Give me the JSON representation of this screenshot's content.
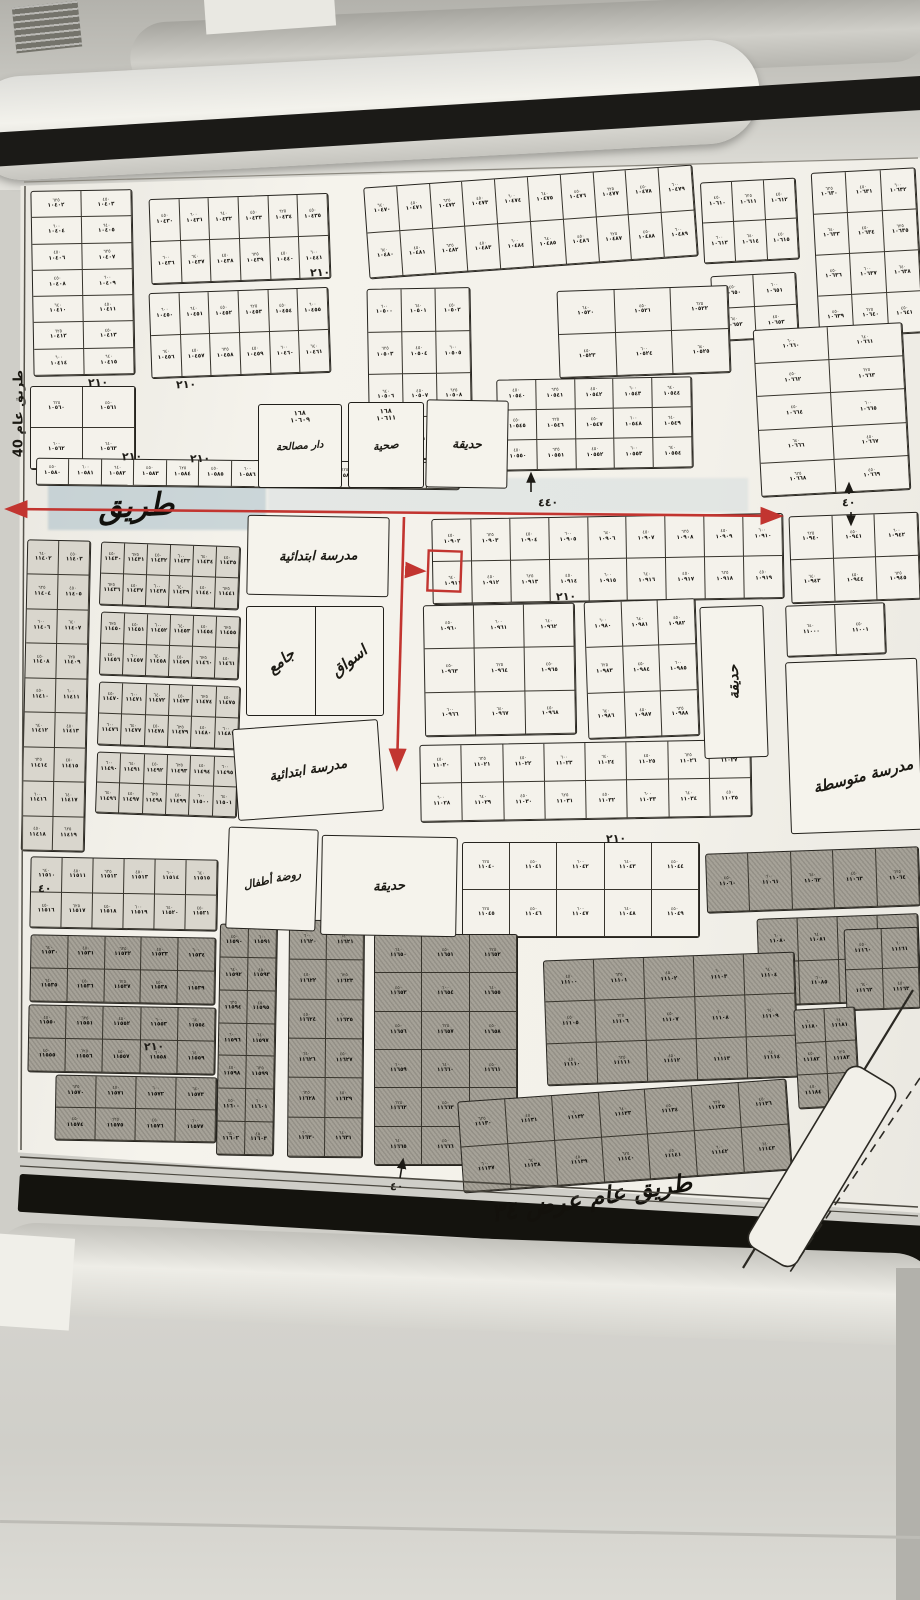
{
  "scene": {
    "wall_color": "#c9c8c2",
    "paper_color": "#f3f1ea",
    "accent_red": "#c23530",
    "highlight_blue": "rgba(162,185,197,0.5)",
    "shaded_plot_color": "#a6a298",
    "light_plot_color": "#d9d6cd"
  },
  "annotations": {
    "road_label": "طريق",
    "left_road_label": "طريق عام 40",
    "bottom_road_label": "طريق عام عرض ٣٤",
    "dimensions": [
      {
        "text": "٢١٠",
        "x": 88,
        "y": 376
      },
      {
        "text": "٢١٠",
        "x": 176,
        "y": 378
      },
      {
        "text": "٢١٠",
        "x": 310,
        "y": 266
      },
      {
        "text": "٢١٠",
        "x": 122,
        "y": 450
      },
      {
        "text": "٢١٠",
        "x": 190,
        "y": 452
      },
      {
        "text": "٢١٠",
        "x": 556,
        "y": 590
      },
      {
        "text": "٢١٠",
        "x": 606,
        "y": 832
      },
      {
        "text": "٢١٠",
        "x": 144,
        "y": 1040
      },
      {
        "text": "٤٤٠",
        "x": 538,
        "y": 496
      },
      {
        "text": "٤٠",
        "x": 842,
        "y": 496
      },
      {
        "text": "٤٠",
        "x": 390,
        "y": 1180
      },
      {
        "text": "٤٠",
        "x": 38,
        "y": 882
      }
    ]
  },
  "highlighted_plot": {
    "x": 428,
    "y": 551,
    "w": 33,
    "h": 40
  },
  "map": {
    "facilities": [
      {
        "label": "دار مصالحة",
        "x": 258,
        "y": 404,
        "w": 84,
        "h": 84,
        "rot": 0,
        "label_rot": -4,
        "size": 10,
        "sub": "١٦٨\n١٠٦٠٩"
      },
      {
        "label": "صحية",
        "x": 348,
        "y": 402,
        "w": 76,
        "h": 86,
        "rot": 0,
        "label_rot": -6,
        "size": 11,
        "sub": "١٦٨\n١٠٦١١"
      },
      {
        "label": "حديقة",
        "x": 426,
        "y": 400,
        "w": 82,
        "h": 88,
        "rot": 1,
        "label_rot": 0,
        "size": 12
      },
      {
        "label": "مدرسة ابتدائية",
        "x": 247,
        "y": 516,
        "w": 142,
        "h": 80,
        "rot": 1,
        "label_rot": -2,
        "size": 13
      },
      {
        "split": [
          "جامع",
          "اسواق"
        ],
        "x": 246,
        "y": 606,
        "w": 138,
        "h": 110,
        "rot": 0,
        "label_rot": -38,
        "size": 15
      },
      {
        "label": "مدرسة ابتدائية",
        "x": 235,
        "y": 724,
        "w": 146,
        "h": 92,
        "rot": -4,
        "label_rot": -6,
        "size": 13
      },
      {
        "label": "روضة أطفال",
        "x": 227,
        "y": 828,
        "w": 90,
        "h": 102,
        "rot": 2,
        "label_rot": -14,
        "size": 11
      },
      {
        "label": "حديقة",
        "x": 321,
        "y": 836,
        "w": 136,
        "h": 100,
        "rot": 1,
        "label_rot": -4,
        "size": 13
      },
      {
        "label": "حديقة",
        "x": 702,
        "y": 606,
        "w": 64,
        "h": 152,
        "rot": -2,
        "label_rot": -90,
        "size": 14
      },
      {
        "label": "مدرسة متوسطة",
        "x": 788,
        "y": 660,
        "w": 132,
        "h": 172,
        "rot": -2,
        "label_rot": -12,
        "size": 15,
        "label_pos": "bottom"
      }
    ],
    "plot_blocks": [
      {
        "x": 32,
        "y": 190,
        "w": 102,
        "h": 186,
        "rows": 7,
        "cols": 2,
        "rot": -1,
        "shade": "w",
        "base": 10402
      },
      {
        "x": 150,
        "y": 196,
        "w": 180,
        "h": 86,
        "rows": 2,
        "cols": 6,
        "rot": -2,
        "shade": "w",
        "base": 10430
      },
      {
        "x": 150,
        "y": 290,
        "w": 180,
        "h": 86,
        "rows": 2,
        "cols": 6,
        "rot": -2,
        "shade": "w",
        "base": 10450
      },
      {
        "x": 366,
        "y": 176,
        "w": 330,
        "h": 92,
        "rows": 2,
        "cols": 10,
        "rot": -4,
        "shade": "w",
        "base": 10470
      },
      {
        "x": 702,
        "y": 180,
        "w": 96,
        "h": 82,
        "rows": 2,
        "cols": 3,
        "rot": -3,
        "shade": "w",
        "base": 10610
      },
      {
        "x": 815,
        "y": 170,
        "w": 105,
        "h": 166,
        "rows": 4,
        "cols": 3,
        "rot": -3,
        "shade": "w",
        "base": 10630
      },
      {
        "x": 712,
        "y": 274,
        "w": 86,
        "h": 66,
        "rows": 2,
        "cols": 2,
        "rot": -3,
        "shade": "w",
        "base": 10650
      },
      {
        "x": 368,
        "y": 288,
        "w": 104,
        "h": 172,
        "rows": 4,
        "cols": 3,
        "rot": -1,
        "shade": "w",
        "base": 10500
      },
      {
        "x": 558,
        "y": 288,
        "w": 172,
        "h": 88,
        "rows": 2,
        "cols": 3,
        "rot": -2,
        "shade": "w",
        "base": 10520
      },
      {
        "x": 497,
        "y": 378,
        "w": 196,
        "h": 92,
        "rows": 3,
        "cols": 5,
        "rot": -1,
        "shade": "w",
        "base": 10540
      },
      {
        "x": 30,
        "y": 386,
        "w": 106,
        "h": 84,
        "rows": 2,
        "cols": 2,
        "rot": 0,
        "shade": "w",
        "base": 10560
      },
      {
        "x": 36,
        "y": 460,
        "w": 424,
        "h": 28,
        "rows": 1,
        "cols": 13,
        "rot": 0.6,
        "shade": "w",
        "base": 10580
      },
      {
        "x": 757,
        "y": 326,
        "w": 150,
        "h": 168,
        "rows": 5,
        "cols": 2,
        "rot": -3,
        "shade": "w",
        "base": 10660
      },
      {
        "x": 24,
        "y": 540,
        "w": 64,
        "h": 312,
        "rows": 9,
        "cols": 2,
        "rot": 1.2,
        "shade": "l",
        "base": 11402
      },
      {
        "x": 100,
        "y": 544,
        "w": 140,
        "h": 64,
        "rows": 2,
        "cols": 6,
        "rot": 2,
        "shade": "l",
        "base": 11430
      },
      {
        "x": 100,
        "y": 614,
        "w": 140,
        "h": 64,
        "rows": 2,
        "cols": 6,
        "rot": 2,
        "shade": "l",
        "base": 11450
      },
      {
        "x": 98,
        "y": 684,
        "w": 142,
        "h": 64,
        "rows": 2,
        "cols": 6,
        "rot": 2,
        "shade": "l",
        "base": 11470
      },
      {
        "x": 96,
        "y": 754,
        "w": 142,
        "h": 62,
        "rows": 2,
        "cols": 6,
        "rot": 2,
        "shade": "l",
        "base": 11490
      },
      {
        "x": 30,
        "y": 858,
        "w": 188,
        "h": 72,
        "rows": 2,
        "cols": 6,
        "rot": 1,
        "shade": "l",
        "base": 11510
      },
      {
        "x": 432,
        "y": 516,
        "w": 352,
        "h": 86,
        "rows": 2,
        "cols": 9,
        "rot": -1,
        "shade": "w",
        "base": 10902
      },
      {
        "x": 790,
        "y": 514,
        "w": 130,
        "h": 88,
        "rows": 2,
        "cols": 3,
        "rot": -2,
        "shade": "w",
        "base": 10940
      },
      {
        "x": 424,
        "y": 604,
        "w": 152,
        "h": 132,
        "rows": 3,
        "cols": 3,
        "rot": -1,
        "shade": "w",
        "base": 10960
      },
      {
        "x": 586,
        "y": 600,
        "w": 112,
        "h": 138,
        "rows": 3,
        "cols": 3,
        "rot": -2,
        "shade": "w",
        "base": 10980
      },
      {
        "x": 786,
        "y": 604,
        "w": 100,
        "h": 52,
        "rows": 1,
        "cols": 2,
        "rot": -2,
        "shade": "w",
        "base": 11000
      },
      {
        "x": 420,
        "y": 742,
        "w": 332,
        "h": 78,
        "rows": 2,
        "cols": 8,
        "rot": -1,
        "shade": "w",
        "base": 11020
      },
      {
        "x": 462,
        "y": 842,
        "w": 238,
        "h": 96,
        "rows": 2,
        "cols": 5,
        "rot": 0,
        "shade": "w",
        "base": 11040
      },
      {
        "x": 706,
        "y": 850,
        "w": 214,
        "h": 60,
        "rows": 1,
        "cols": 5,
        "rot": -2,
        "shade": "d",
        "base": 11060
      },
      {
        "x": 758,
        "y": 916,
        "w": 162,
        "h": 88,
        "rows": 2,
        "cols": 4,
        "rot": -2,
        "shade": "d",
        "base": 11080
      },
      {
        "x": 30,
        "y": 936,
        "w": 186,
        "h": 68,
        "rows": 2,
        "cols": 5,
        "rot": 1,
        "shade": "d",
        "base": 11530
      },
      {
        "x": 28,
        "y": 1006,
        "w": 188,
        "h": 68,
        "rows": 2,
        "cols": 5,
        "rot": 1,
        "shade": "d",
        "base": 11550
      },
      {
        "x": 55,
        "y": 1076,
        "w": 162,
        "h": 66,
        "rows": 2,
        "cols": 4,
        "rot": 1,
        "shade": "d",
        "base": 11570
      },
      {
        "x": 218,
        "y": 924,
        "w": 58,
        "h": 232,
        "rows": 7,
        "cols": 2,
        "rot": 1,
        "shade": "d",
        "base": 11590
      },
      {
        "x": 288,
        "y": 920,
        "w": 76,
        "h": 238,
        "rows": 6,
        "cols": 2,
        "rot": 0.5,
        "shade": "d",
        "base": 11620
      },
      {
        "x": 374,
        "y": 934,
        "w": 144,
        "h": 232,
        "rows": 6,
        "cols": 3,
        "rot": 0,
        "shade": "d",
        "base": 11650
      },
      {
        "x": 545,
        "y": 956,
        "w": 252,
        "h": 126,
        "rows": 3,
        "cols": 5,
        "rot": -2,
        "shade": "d",
        "base": 11100
      },
      {
        "x": 460,
        "y": 1090,
        "w": 330,
        "h": 92,
        "rows": 2,
        "cols": 7,
        "rot": -4,
        "shade": "d",
        "base": 11130
      },
      {
        "x": 845,
        "y": 928,
        "w": 75,
        "h": 82,
        "rows": 2,
        "cols": 2,
        "rot": -2,
        "shade": "d",
        "base": 11160
      },
      {
        "x": 796,
        "y": 1008,
        "w": 62,
        "h": 100,
        "rows": 3,
        "cols": 2,
        "rot": -3,
        "shade": "d",
        "base": 11180
      }
    ],
    "area_samples": [
      "٦٢٥",
      "٤٥٠",
      "٦٠٠",
      "٦٤٠",
      "٤٥٠"
    ],
    "plot_number_samples": [
      "١٠٦١٢",
      "١٠٦١٤",
      "١٠٦١٦",
      "١٠٨٤٦",
      "١٠٩٠٢",
      "١١٠٤٦",
      "١١١٠٢",
      "١١١٠٤",
      "١١٤٤٠"
    ]
  }
}
